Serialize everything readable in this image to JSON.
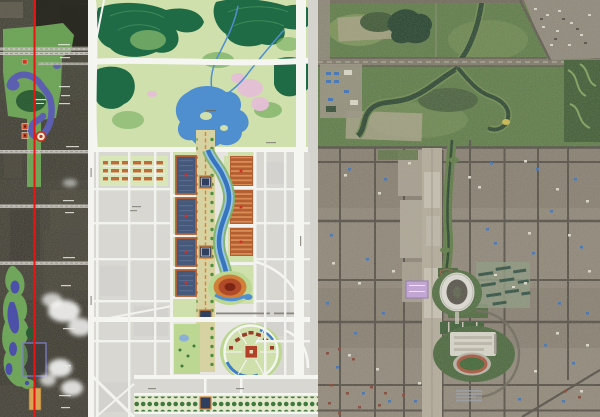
{
  "meta": {
    "width_px": 600,
    "height_px": 417
  },
  "figure": {
    "kind": "three-panel map comparison of a city north-south axis",
    "panel_count": 3
  },
  "panels": {
    "left": {
      "label": "city-axis-satellite-strip-with-plan-overlay"
    },
    "middle": {
      "label": "olympic-green-master-plan-drawing"
    },
    "right": {
      "label": "satellite-photograph-of-district"
    }
  },
  "icons": {
    "axis_line": "red-axis-line",
    "stadium_marker": "ring-marker",
    "site_markers": "orange-square-markers",
    "palace_outline": "purple-square-outline"
  },
  "palette": {
    "axis_red": "#e81414",
    "overlay_green": "#74b05e",
    "overlay_water": "#5c5fb0",
    "marker_orange": "#d8a455",
    "forest_dark": "#1e6b45",
    "park_lawn": "#cfe0ac",
    "lake_blue": "#4f8fd0",
    "axis_band": "#d6d2a2",
    "axis_dash": "#e0812f",
    "terracotta": "#b45f32",
    "court_blue": "#47597a",
    "stadium_orange": "#d08038",
    "blossom_pink": "#e6bfd7",
    "plan_road_white": "#f5f5f2",
    "plan_block_gray": "#d8d7d2",
    "sat_park_green": "#5c7a46",
    "sat_urban_gray": "#8b8377",
    "sat_water_dark": "#22402c",
    "corridor_pale": "#b2aa9a",
    "venue_purple": "#c2a2d8",
    "cloud_white": "#ffffff"
  }
}
